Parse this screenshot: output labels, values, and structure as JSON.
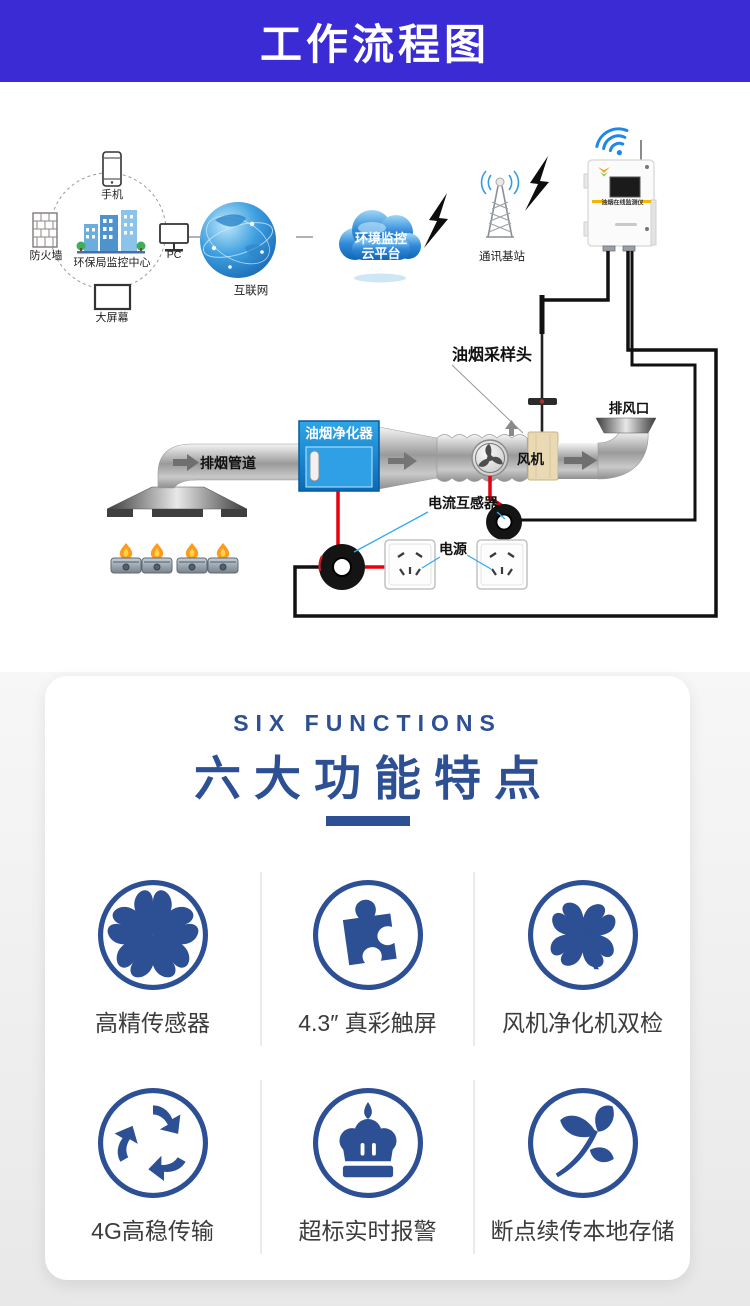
{
  "banner": {
    "title": "工作流程图",
    "bg_color": "#3b2bd4"
  },
  "diagram": {
    "labels": {
      "phone": "手机",
      "firewall": "防火墙",
      "epa_center": "环保局监控中心",
      "pc": "PC",
      "big_screen": "大屏幕",
      "internet": "互联网",
      "cloud_line1": "环境监控",
      "cloud_line2": "云平台",
      "base_station": "通讯基站",
      "device": "油烟在线监测仪",
      "sampling_head": "油烟采样头",
      "exhaust_outlet": "排风口",
      "fan": "风机",
      "exhaust_pipe": "排烟管道",
      "purifier": "油烟净化器",
      "current_transformer": "电流互感器",
      "power": "电源"
    },
    "colors": {
      "wire_black": "#111111",
      "wire_red": "#e8000b",
      "pointer_blue": "#35aaf0",
      "purifier_blue": "#1a8fd4"
    }
  },
  "features": {
    "eyebrow": "SIX FUNCTIONS",
    "title": "六大功能特点",
    "accent_color": "#2d4f93",
    "items": [
      {
        "icon": "flower-icon",
        "label": "高精传感器"
      },
      {
        "icon": "puzzle-icon",
        "label": "4.3″ 真彩触屏"
      },
      {
        "icon": "clover-icon",
        "label": "风机净化机双检"
      },
      {
        "icon": "recycle-icon",
        "label": "4G高稳传输"
      },
      {
        "icon": "crown-icon",
        "label": "超标实时报警"
      },
      {
        "icon": "leaf-icon",
        "label": "断点续传本地存储"
      }
    ]
  }
}
